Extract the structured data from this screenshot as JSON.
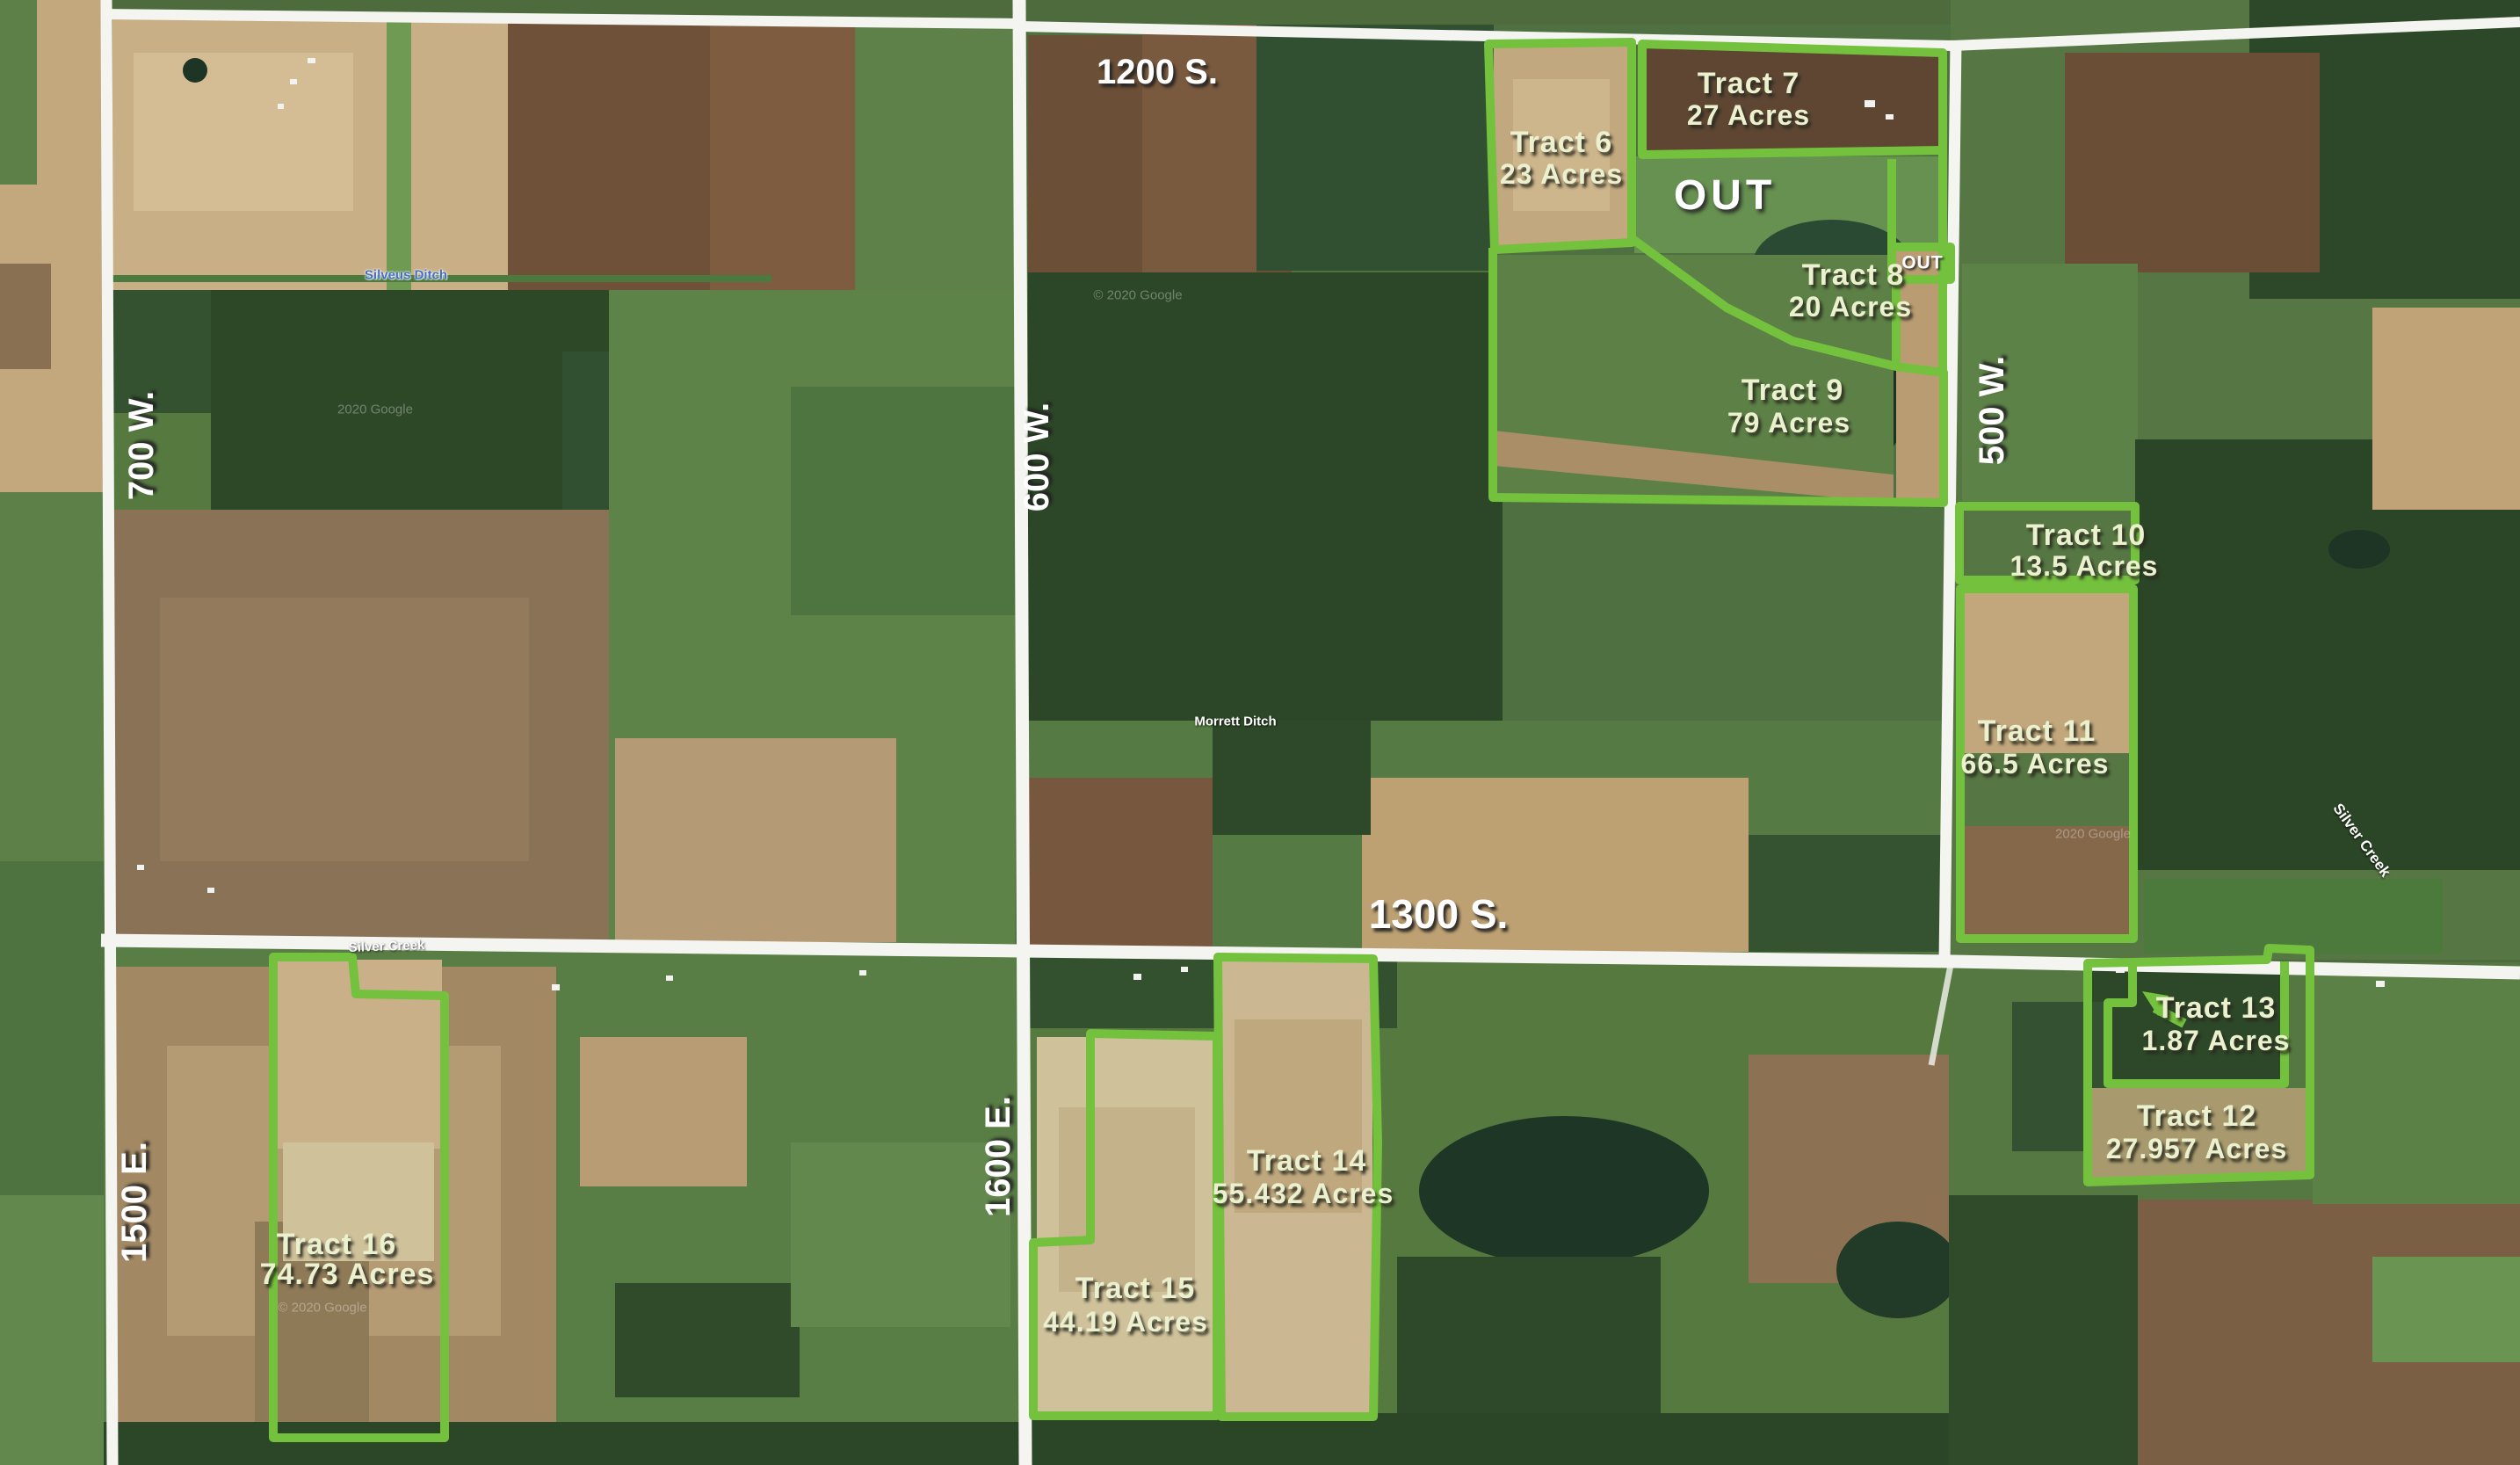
{
  "map_title": "Aerial farmland auction tract map",
  "colors": {
    "boundary_green": "#74c13d",
    "road_white": "#f4f4f1",
    "tract_label": "#ebf1cf",
    "waterway_blue": "#4570c6"
  },
  "road_labels": [
    {
      "text": "1200 S."
    },
    {
      "text": "1300 S."
    },
    {
      "text": "700 W."
    },
    {
      "text": "600 W."
    },
    {
      "text": "500 W."
    },
    {
      "text": "1500 E."
    },
    {
      "text": "1600 E."
    }
  ],
  "tracts": [
    {
      "name": "Tract 6",
      "acres": "23 Acres"
    },
    {
      "name": "Tract 7",
      "acres": "27 Acres"
    },
    {
      "name": "Tract 8",
      "acres": "20 Acres"
    },
    {
      "name": "Tract 9",
      "acres": "79 Acres"
    },
    {
      "name": "Tract 10",
      "acres": "13.5 Acres"
    },
    {
      "name": "Tract 11",
      "acres": "66.5 Acres"
    },
    {
      "name": "Tract 12",
      "acres": "27.957 Acres"
    },
    {
      "name": "Tract 13",
      "acres": "1.87 Acres"
    },
    {
      "name": "Tract 14",
      "acres": "55.432 Acres"
    },
    {
      "name": "Tract 15",
      "acres": "44.19 Acres"
    },
    {
      "name": "Tract 16",
      "acres": "74.73 Acres"
    }
  ],
  "out_labels": [
    {
      "text": "OUT"
    },
    {
      "text": "OUT"
    }
  ],
  "waterway_labels": [
    {
      "text": "Silveus Ditch"
    },
    {
      "text": "Morrett Ditch"
    },
    {
      "text": "Silver Creek"
    },
    {
      "text": "Silver Creek"
    }
  ],
  "watermarks": [
    {
      "text": "© 2020 Google"
    },
    {
      "text": "2020 Google"
    },
    {
      "text": "© 2020 Google"
    },
    {
      "text": "2020 Google"
    }
  ]
}
